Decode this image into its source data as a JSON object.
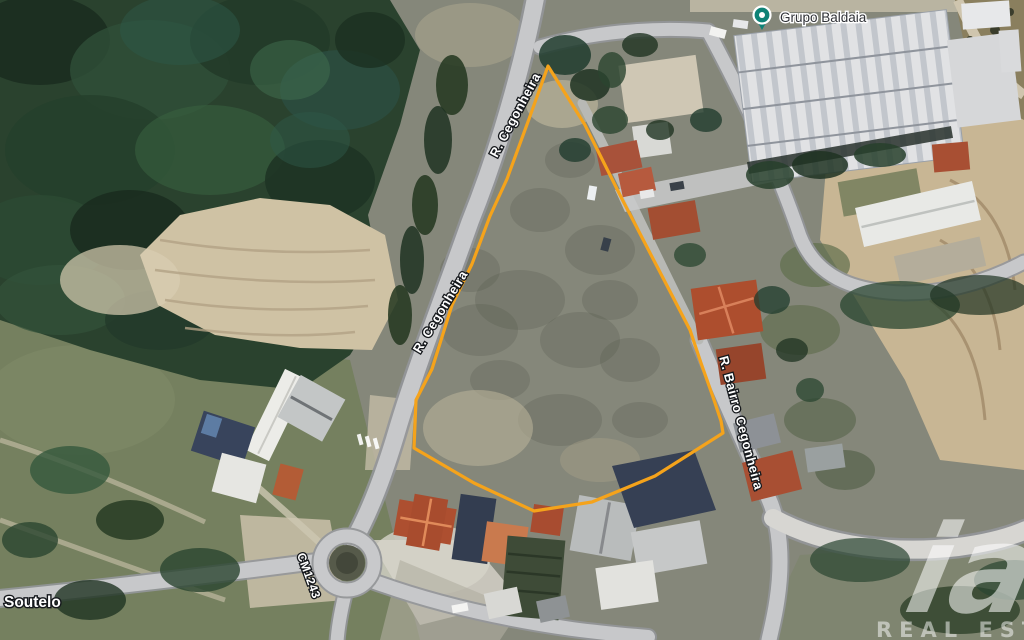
{
  "map": {
    "poi": {
      "name": "Grupo Baldaia",
      "pin_color": "#0E8276"
    },
    "place": "Soutelo",
    "roads": {
      "cegonheira_top": "R. Cegonheira",
      "cegonheira_mid": "R. Cegonheira",
      "bairro": "R. Bairro Cegonheira",
      "cm": "CM1243"
    },
    "parcel": {
      "outline_color": "#F5A31B",
      "points": "548,66 585,125 622,199 662,276 690,330 701,363 713,397 721,421 723,433 655,476 592,502 534,511 474,483 414,448 416,400 432,369 452,305 472,264 490,216 507,179 529,119"
    }
  },
  "watermark": {
    "logo": "iad",
    "tagline": "REAL ESTATE"
  }
}
